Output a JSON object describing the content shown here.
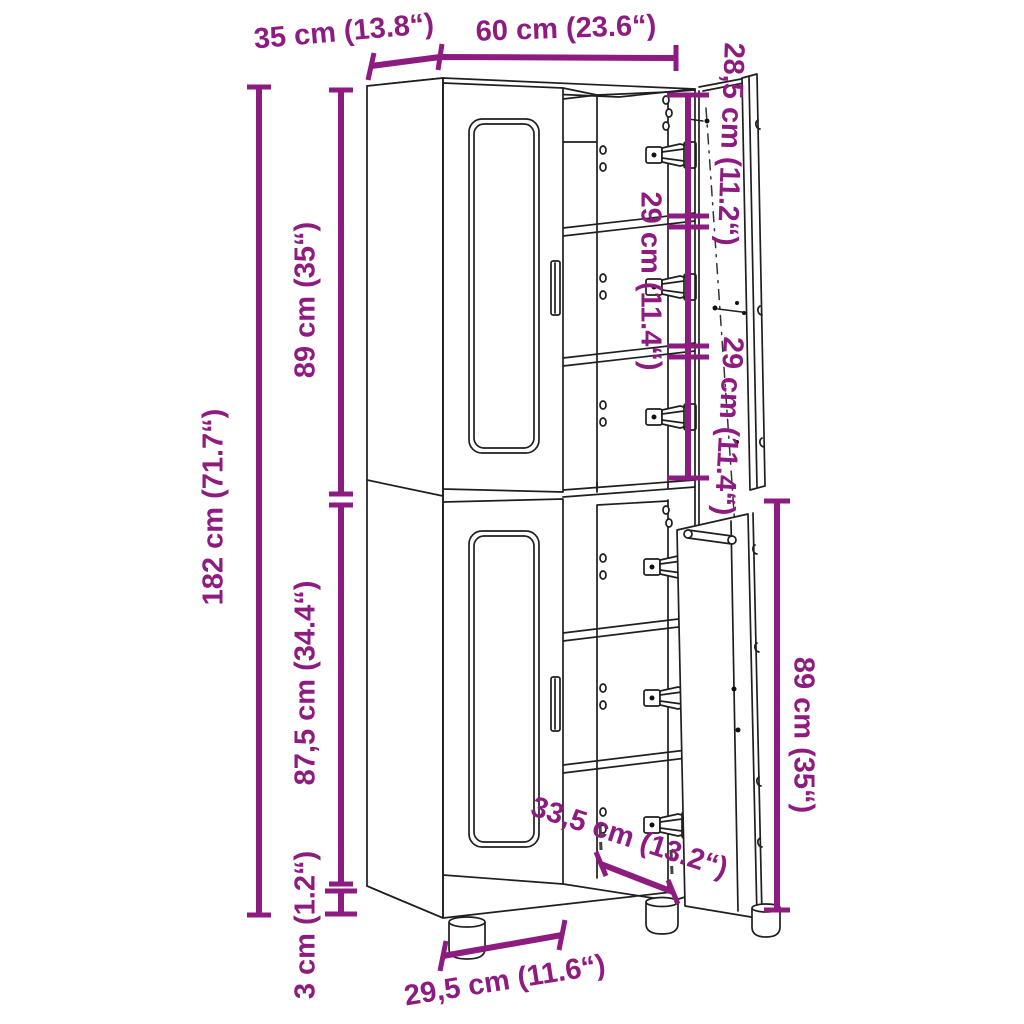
{
  "diagram": {
    "title": "cabinet-dimension-diagram",
    "accent_color": "#8e1b80",
    "line_color": "#1f1f1f",
    "labels": {
      "depth": "35 cm (13.8“)",
      "width": "60 cm (23.6“)",
      "top_compartment_height": "28,5 cm (11.2“)",
      "middle_compartment_height": "29 cm (11.4“)",
      "lower_compartment_height": "29 cm (11.4“)",
      "upper_section_height": "89 cm (35“)",
      "total_height": "182 cm (71.7“)",
      "lower_section_height": "87,5 cm (34.4“)",
      "feet_height": "3 cm (1.2“)",
      "lower_door_height": "89 cm (35“)",
      "inner_width": "33,5 cm (13.2“)",
      "base_width": "29,5 cm (11.6“)"
    }
  }
}
